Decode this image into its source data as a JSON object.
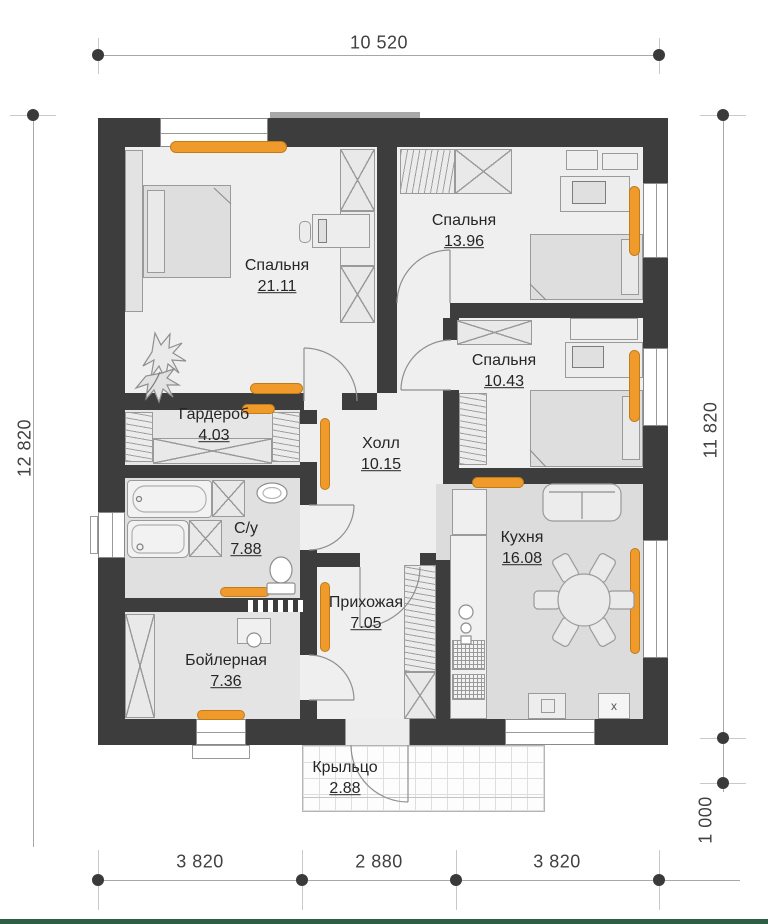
{
  "rooms": [
    {
      "name": "Спальня",
      "area": "21.11"
    },
    {
      "name": "Спальня",
      "area": "13.96"
    },
    {
      "name": "Спальня",
      "area": "10.43"
    },
    {
      "name": "Гардероб",
      "area": "4.03"
    },
    {
      "name": "Холл",
      "area": "10.15"
    },
    {
      "name": "С/у",
      "area": "7.88"
    },
    {
      "name": "Кухня",
      "area": "16.08"
    },
    {
      "name": "Прихожая",
      "area": "7.05"
    },
    {
      "name": "Бойлерная",
      "area": "7.36"
    },
    {
      "name": "Крыльцо",
      "area": "2.88"
    }
  ],
  "dims": {
    "top": "10 520",
    "left": "12 820",
    "right": "11 820",
    "right_lower": "1 000",
    "bottom": [
      "3 820",
      "2 880",
      "3 820"
    ]
  },
  "markers": {
    "vent": "x"
  },
  "colors": {
    "wall": "#3d3d3d",
    "radiator": "#f09a2c",
    "floor": "#efefef",
    "accent_bar": "#2d5f45"
  }
}
